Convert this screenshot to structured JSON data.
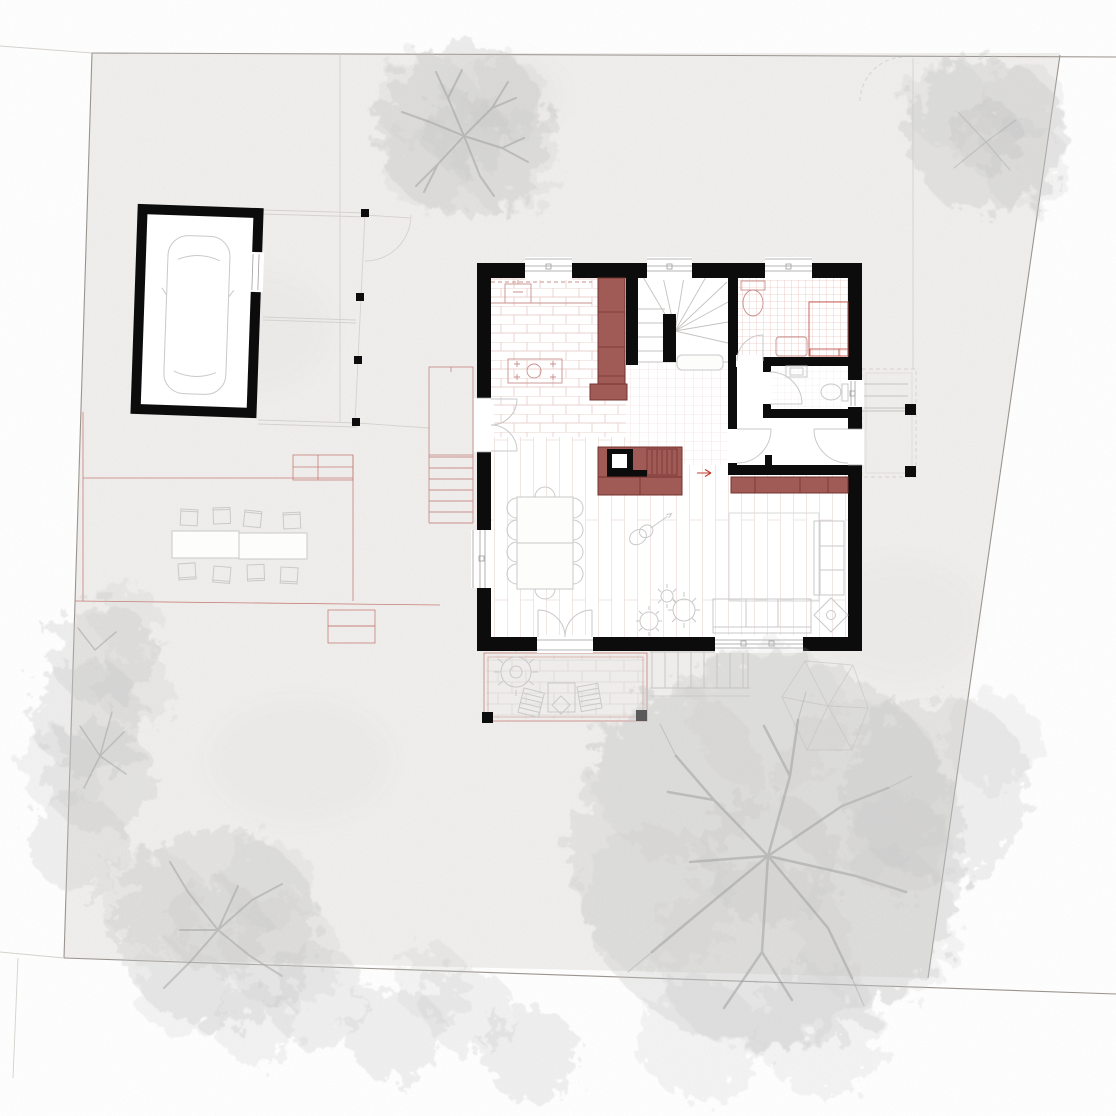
{
  "page": {
    "background": "#ffffff",
    "width_px": 1116,
    "height_px": 1116
  },
  "plan": {
    "kind": "Residential site plan with ground-floor layout",
    "aria_label": "Architectural site plan: ground floor of a house with garage, carport, terraces, garden trees and climbing dome",
    "colors": {
      "wall": "#0c0c0c",
      "house_fill": "#ffffff",
      "site_fill": "#f1f0ee",
      "boundary": "#9a948f",
      "faint_line": "#d5d1cd",
      "furniture_fill": "#a15b56",
      "furniture_stroke": "#74332f",
      "accent_red": "#c0392b",
      "fixture_pink": "#c9908c",
      "shower_red": "#c4574f",
      "patio_red": "#c77e78",
      "kitchen_tile": "#e5c5c0",
      "bath_tile": "#dfaca6",
      "hall_tile": "#ead7d3",
      "plank_line": "#ecdcda",
      "pave_line": "#ddd6d3",
      "furn_line": "#c9c9c9",
      "step_line": "#c6c3c0",
      "tree_fill": "#c3c3c3",
      "tree_core": "#b5b5b5",
      "branch": "#a0a0a0"
    },
    "house": {
      "rooms": [
        "kitchen",
        "stair-hall",
        "bathroom",
        "wc",
        "closet",
        "living-dining"
      ],
      "fixtures": [
        "kitchen-sink",
        "cooktop-island",
        "tall-cabinet",
        "winder-staircase",
        "toilet",
        "shower",
        "vanity",
        "washbasin",
        "fireplace-with-bench",
        "sideboard",
        "dining-table-with-10-chairs",
        "rug",
        "sofa",
        "chaise",
        "side-table",
        "guitar",
        "potted-plants"
      ]
    },
    "outbuildings": [
      "garage-with-car",
      "carport"
    ],
    "outdoor": [
      "west-entry-stairs",
      "south-terrace-with-lounge-chairs",
      "garden-steps",
      "east-porch",
      "climbing-dome",
      "outdoor-dining-set",
      "patio-edges"
    ],
    "trees": [
      "top-center-tree",
      "top-right-tree",
      "left-hedge",
      "bottom-left-tree",
      "bottom-hedge",
      "big-garden-tree",
      "right-garden-tree"
    ]
  }
}
